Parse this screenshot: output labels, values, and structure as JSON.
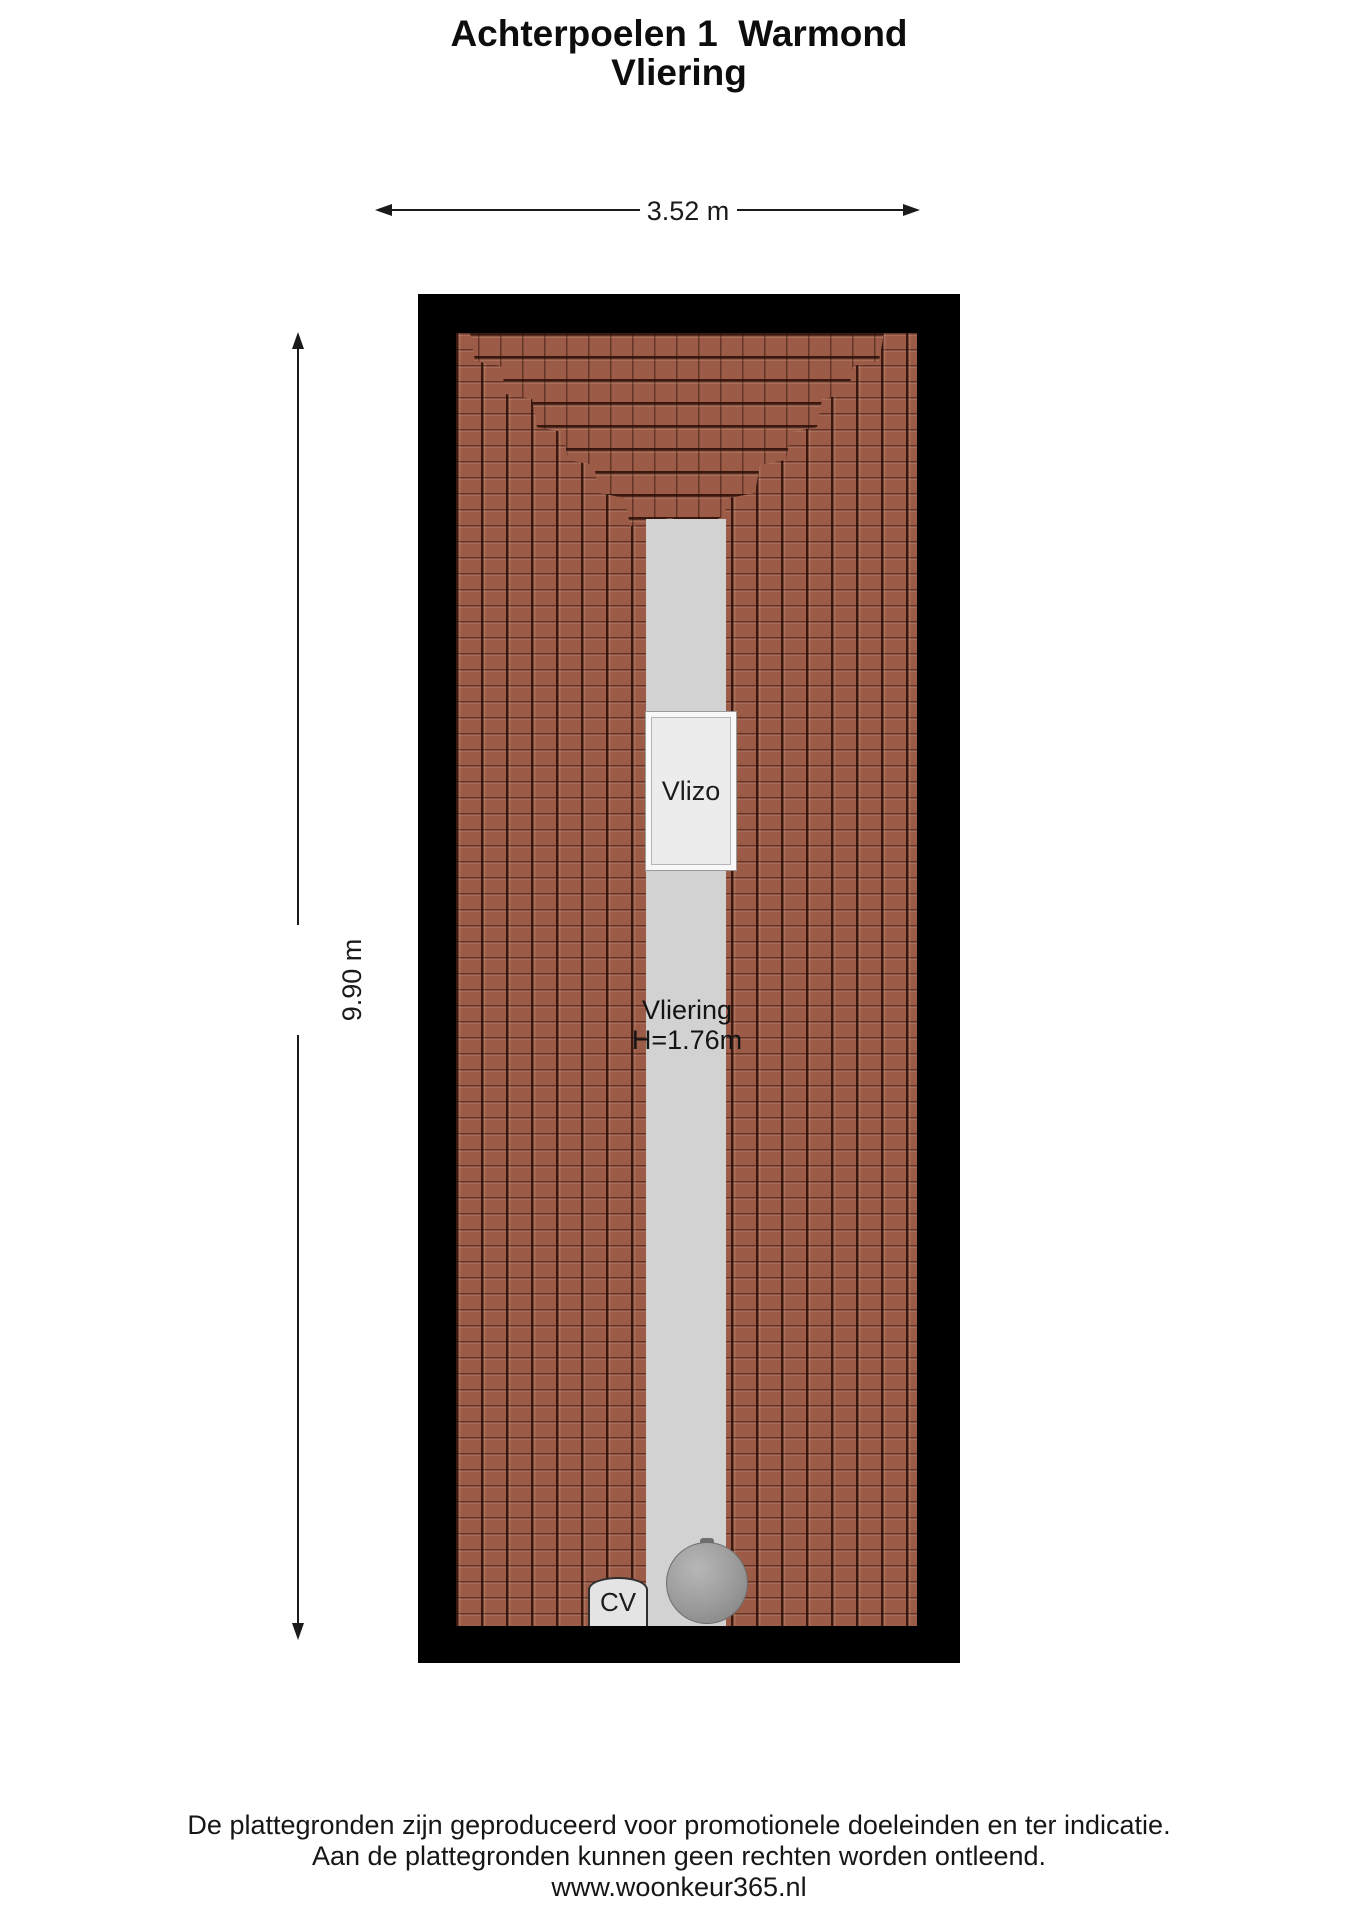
{
  "title": {
    "line1": "Achterpoelen 1  Warmond",
    "line2": "Vliering"
  },
  "dimensions": {
    "width_label": "3.52 m",
    "height_label": "9.90 m"
  },
  "floor_plan": {
    "room": {
      "name": "Vliering",
      "height_note": "H=1.76m"
    },
    "hatch_label": "Vlizo",
    "cv_label": "CV",
    "colors": {
      "wall": "#000000",
      "tile_base": "#9c5b46",
      "floor_strip": "#d2d2d2",
      "hatch_fill": "#ececec",
      "boiler": "#9a9a9a"
    }
  },
  "footer": {
    "line1": "De plattegronden zijn geproduceerd voor promotionele doeleinden en ter indicatie.",
    "line2": "Aan de plattegronden kunnen geen rechten worden ontleend.",
    "line3": "www.woonkeur365.nl"
  }
}
